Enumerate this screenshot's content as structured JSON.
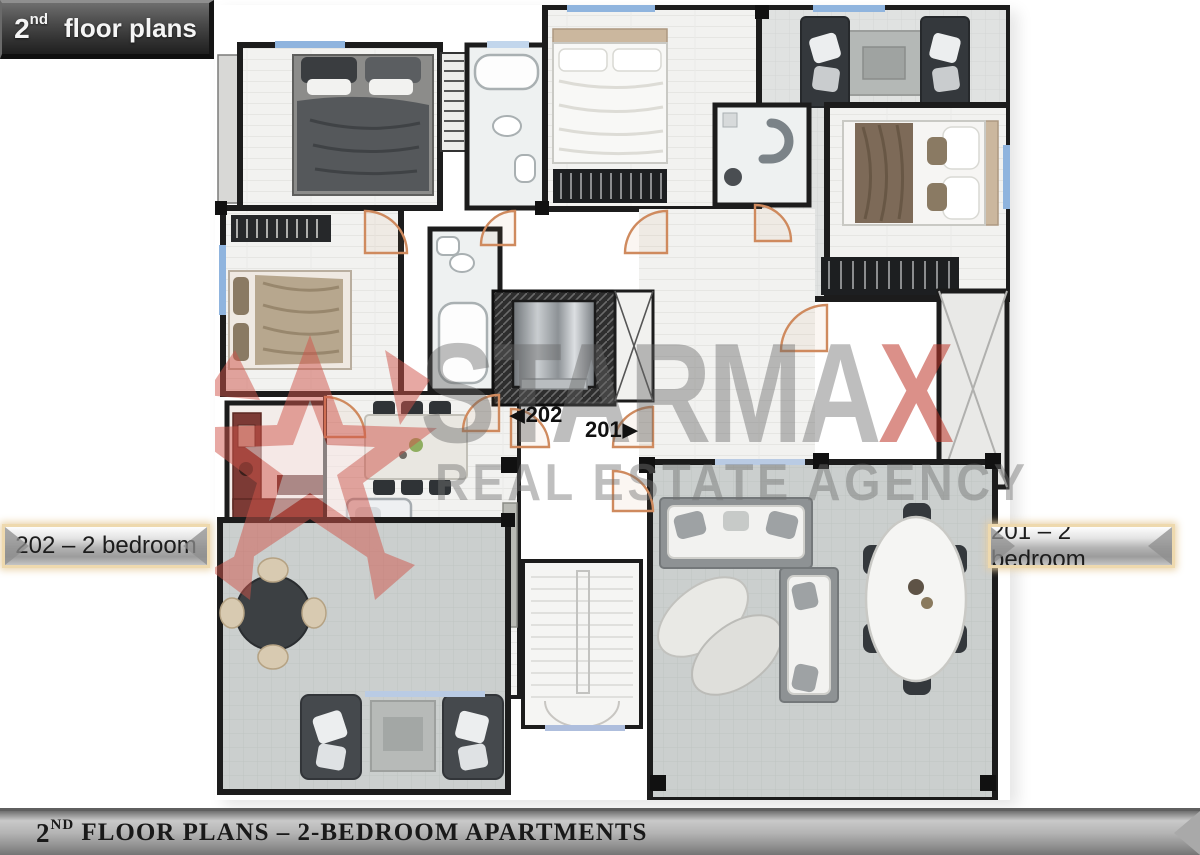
{
  "title_badge": {
    "number": "2",
    "ordinal": "nd",
    "text": "floor plans"
  },
  "unit_labels": {
    "left": "202 – 2 bedroom",
    "right": "201 – 2 bedroom"
  },
  "plan": {
    "door_tags": {
      "left": {
        "arrow": "◀",
        "label": "202"
      },
      "right": {
        "label": "201",
        "arrow": "▶"
      }
    },
    "watermark": {
      "brand_prefix": "STARMA",
      "brand_suffix": "X",
      "tagline": "REAL ESTATE AGENCY"
    }
  },
  "footer": {
    "number": "2",
    "ordinal": "ND",
    "text": " FLOOR PLANS – 2-BEDROOM APARTMENTS"
  },
  "palette": {
    "wall_black": "#1c1c1c",
    "terrace_tile": "#cbcfce",
    "interior_tile": "#e0e2e1",
    "wood_floor": "#f2f2f0",
    "logo_red": "#be3428",
    "door_arc_orange": "#cf8a5e",
    "window_blue": "#8fb4de",
    "badge_dark": "#303030",
    "plaque_silver": "#c4c4c4",
    "plaque_border_tan": "#eed9ae",
    "kitchen_red": "#7c3a35",
    "sofa_dark": "#34383c"
  }
}
